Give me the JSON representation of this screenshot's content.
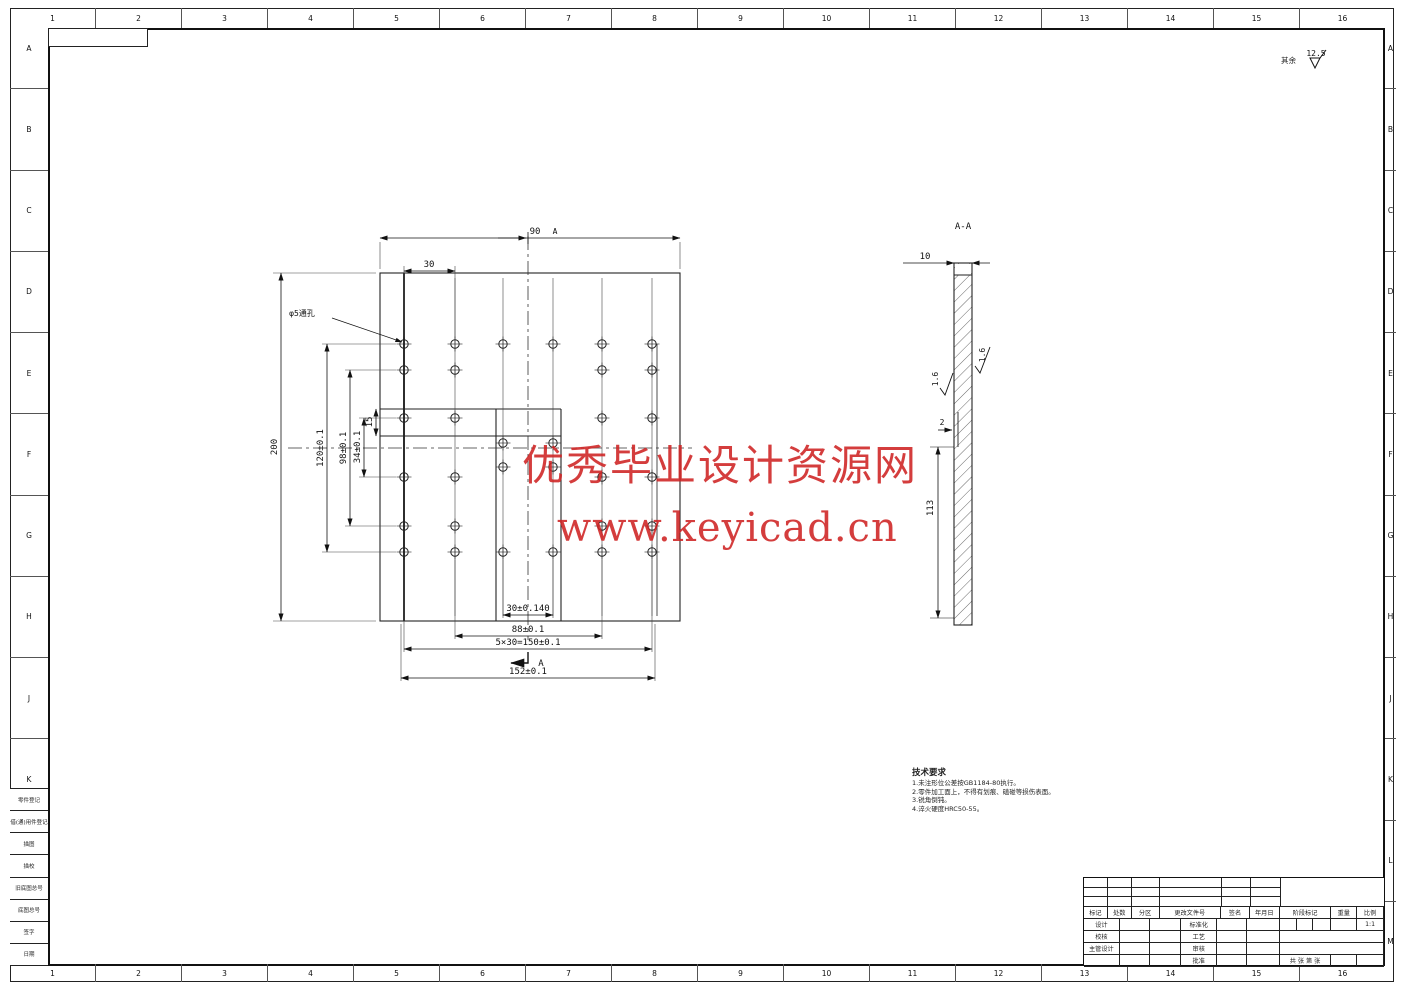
{
  "sheet": {
    "background": "#ffffff",
    "line_color": "#1f1f1f",
    "watermark_color": "#cf2323"
  },
  "zones": {
    "columns": [
      "1",
      "2",
      "3",
      "4",
      "5",
      "6",
      "7",
      "8",
      "9",
      "10",
      "11",
      "12",
      "13",
      "14",
      "15",
      "16"
    ],
    "rows": [
      "A",
      "B",
      "C",
      "D",
      "E",
      "F",
      "G",
      "H",
      "J",
      "K",
      "L",
      "M"
    ]
  },
  "surface_note": {
    "prefix": "其余",
    "value": "12.5"
  },
  "plan_view": {
    "hole_note": "φ5通孔",
    "dim_half_width": "90",
    "datum": "A",
    "dim_pitch": "30",
    "dim_height": "200",
    "dim_v120": "120±0.1",
    "dim_v98": "98±0.1",
    "dim_v34": "34±0.1",
    "dim_v15": "15",
    "dim_b30": "30±0.140",
    "dim_b88": "88±0.1",
    "dim_b150": "5×30=150±0.1",
    "dim_b152": "152±0.1",
    "section_arrow": "A"
  },
  "section_view": {
    "title": "A-A",
    "dim_thickness": "10",
    "dim_depth": "113",
    "dim_step": "2",
    "rough_left": "1.6",
    "rough_right": "1.6"
  },
  "tech_req": {
    "title": "技术要求",
    "lines": [
      "1.未注形位公差按GB1184-80执行。",
      "2.零件加工面上，不得有划痕、磕碰等损伤表面。",
      "3.锐角倒钝。",
      "4.淬火硬度HRC50-55。"
    ]
  },
  "watermark": {
    "line1": "优秀毕业设计资源网",
    "line2": "www.keyicad.cn"
  },
  "margin_table": {
    "rows": [
      "零件登记",
      "借(通)用件登记",
      "描图",
      "描校",
      "旧底图总号",
      "底图总号",
      "签字",
      "日期"
    ]
  },
  "title_block": {
    "rev_cols": [
      "标记",
      "处数",
      "分区",
      "更改文件号",
      "签名",
      "年月日"
    ],
    "sign_left": [
      "设计",
      "校核",
      "主管设计",
      ""
    ],
    "sign_mid": [
      "标准化",
      "工艺",
      "审核",
      "批准"
    ],
    "stage_label": "阶段标记",
    "weight_label": "重量",
    "scale_label": "比例",
    "scale_value": "1:1",
    "sheets_label": "共 张 第 张"
  }
}
